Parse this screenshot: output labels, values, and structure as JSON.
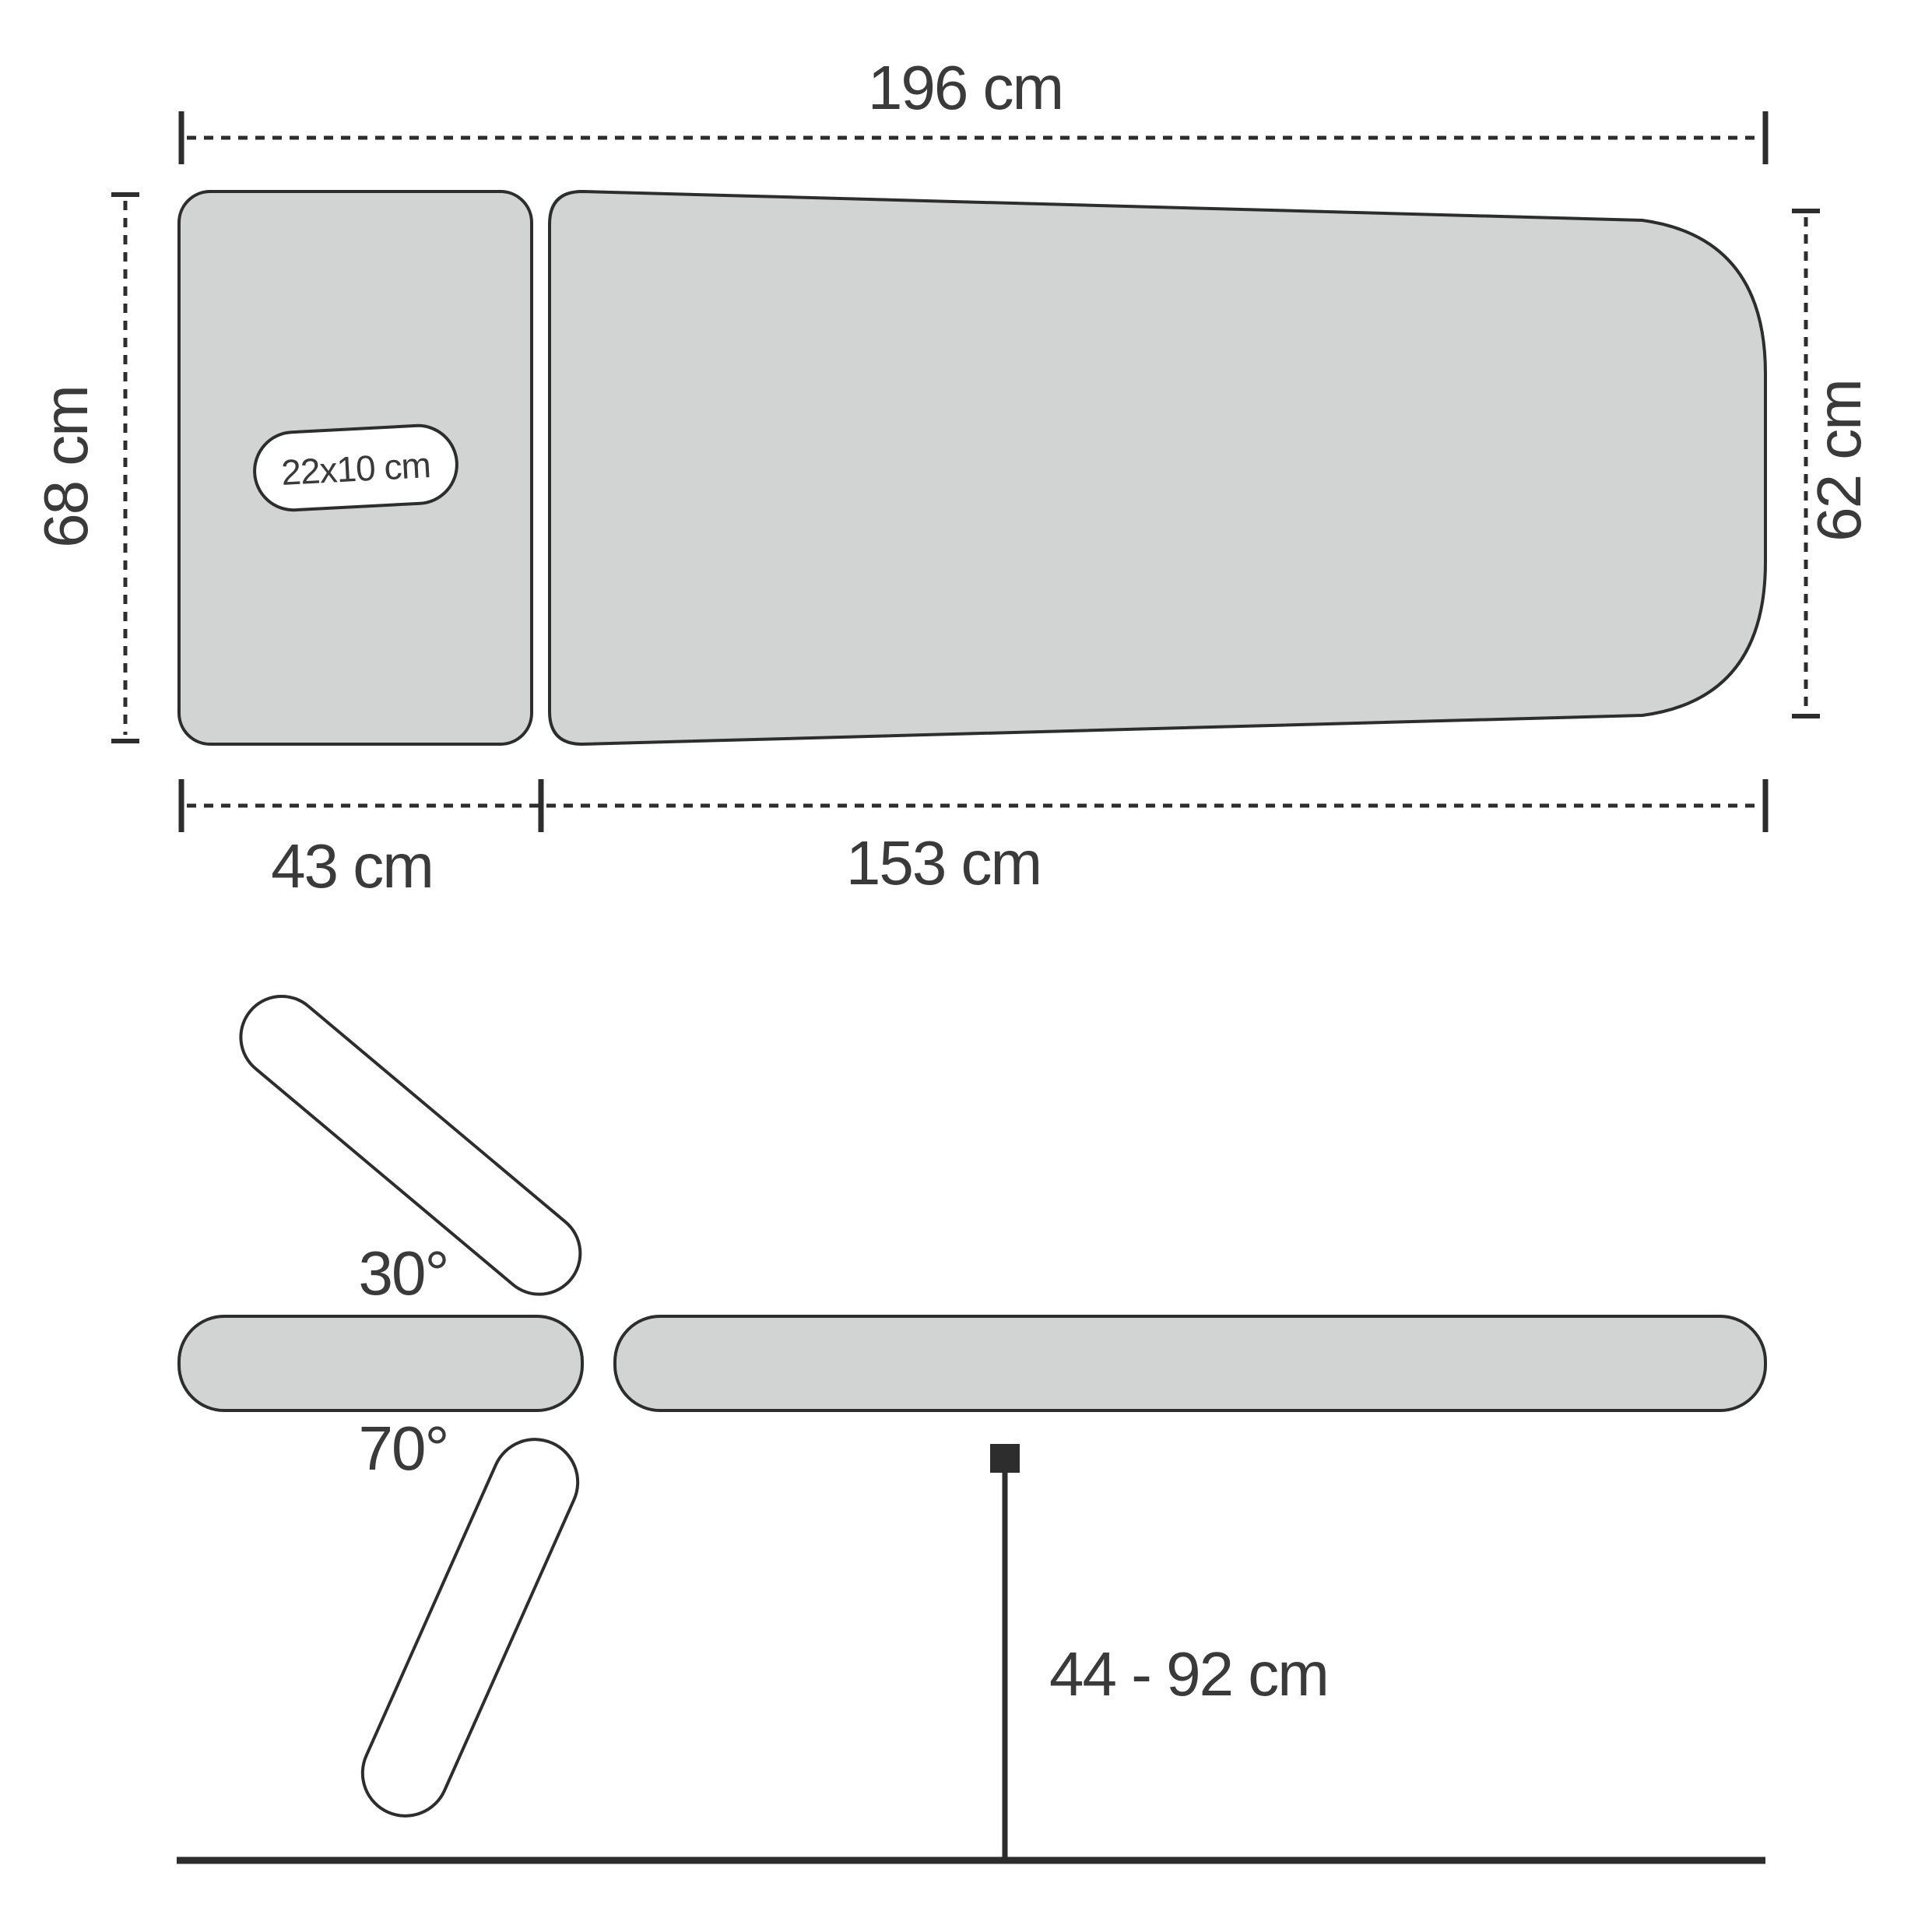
{
  "diagram": {
    "title_semantic": "massage table dimensions diagram",
    "top_view": {
      "total_length_label": "196 cm",
      "head_end_width_label": "68 cm",
      "foot_end_width_label": "62 cm",
      "headrest_length_label": "43 cm",
      "main_section_length_label": "153 cm",
      "face_hole_label": "22x10 cm"
    },
    "side_view": {
      "headrest_up_angle_label": "30°",
      "headrest_down_angle_label": "70°",
      "height_range_label": "44 - 92 cm"
    },
    "colors": {
      "surface_fill": "#d2d3d3",
      "outline": "#2d2d2e",
      "text_color": "#3a3a3a",
      "bg": "#ffffff"
    }
  }
}
